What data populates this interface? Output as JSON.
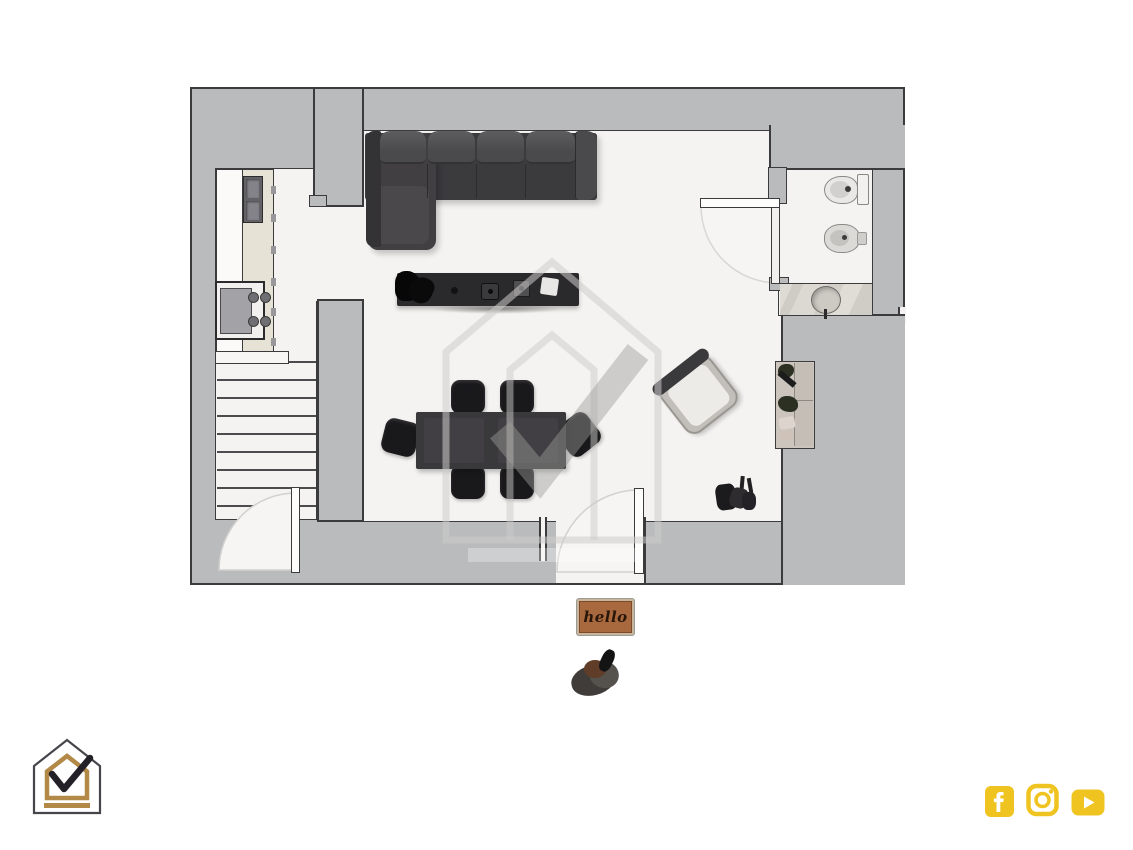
{
  "scene": {
    "type": "floor-plan-top-view",
    "background": "#ffffff"
  },
  "floor_plan": {
    "wall_fill": "#b9bbbd",
    "wall_outline": "#3b3b3d",
    "floor_fill": "#f4f3f1",
    "areas": [
      "living-dining-room",
      "kitchen",
      "bathroom",
      "staircase",
      "entry-vestibule"
    ],
    "furniture": [
      "corner-sofa",
      "media-console",
      "dining-table",
      "six-dining-chairs",
      "armchair",
      "desk-unit",
      "kitchen-counter-with-double-sink",
      "oven-and-cooktop",
      "toilet",
      "bidet",
      "washbasin-counter",
      "stairs",
      "shoe-caddy"
    ]
  },
  "doormat": {
    "text": "hello",
    "fill": "#a8693f",
    "border": "#c9b59a",
    "text_color": "#2a1608"
  },
  "outside_items": [
    "pair-of-boots"
  ],
  "watermark": {
    "shape": "house-with-checkmark",
    "color": "rgba(180,179,177,0.5)"
  },
  "branding_logo": {
    "shape": "house-with-checkmark",
    "outline": "#45454c",
    "gold": "#b28947",
    "check": "#232127"
  },
  "social_bar": {
    "color": "#f0c420",
    "icons": [
      "facebook",
      "instagram",
      "youtube"
    ]
  }
}
